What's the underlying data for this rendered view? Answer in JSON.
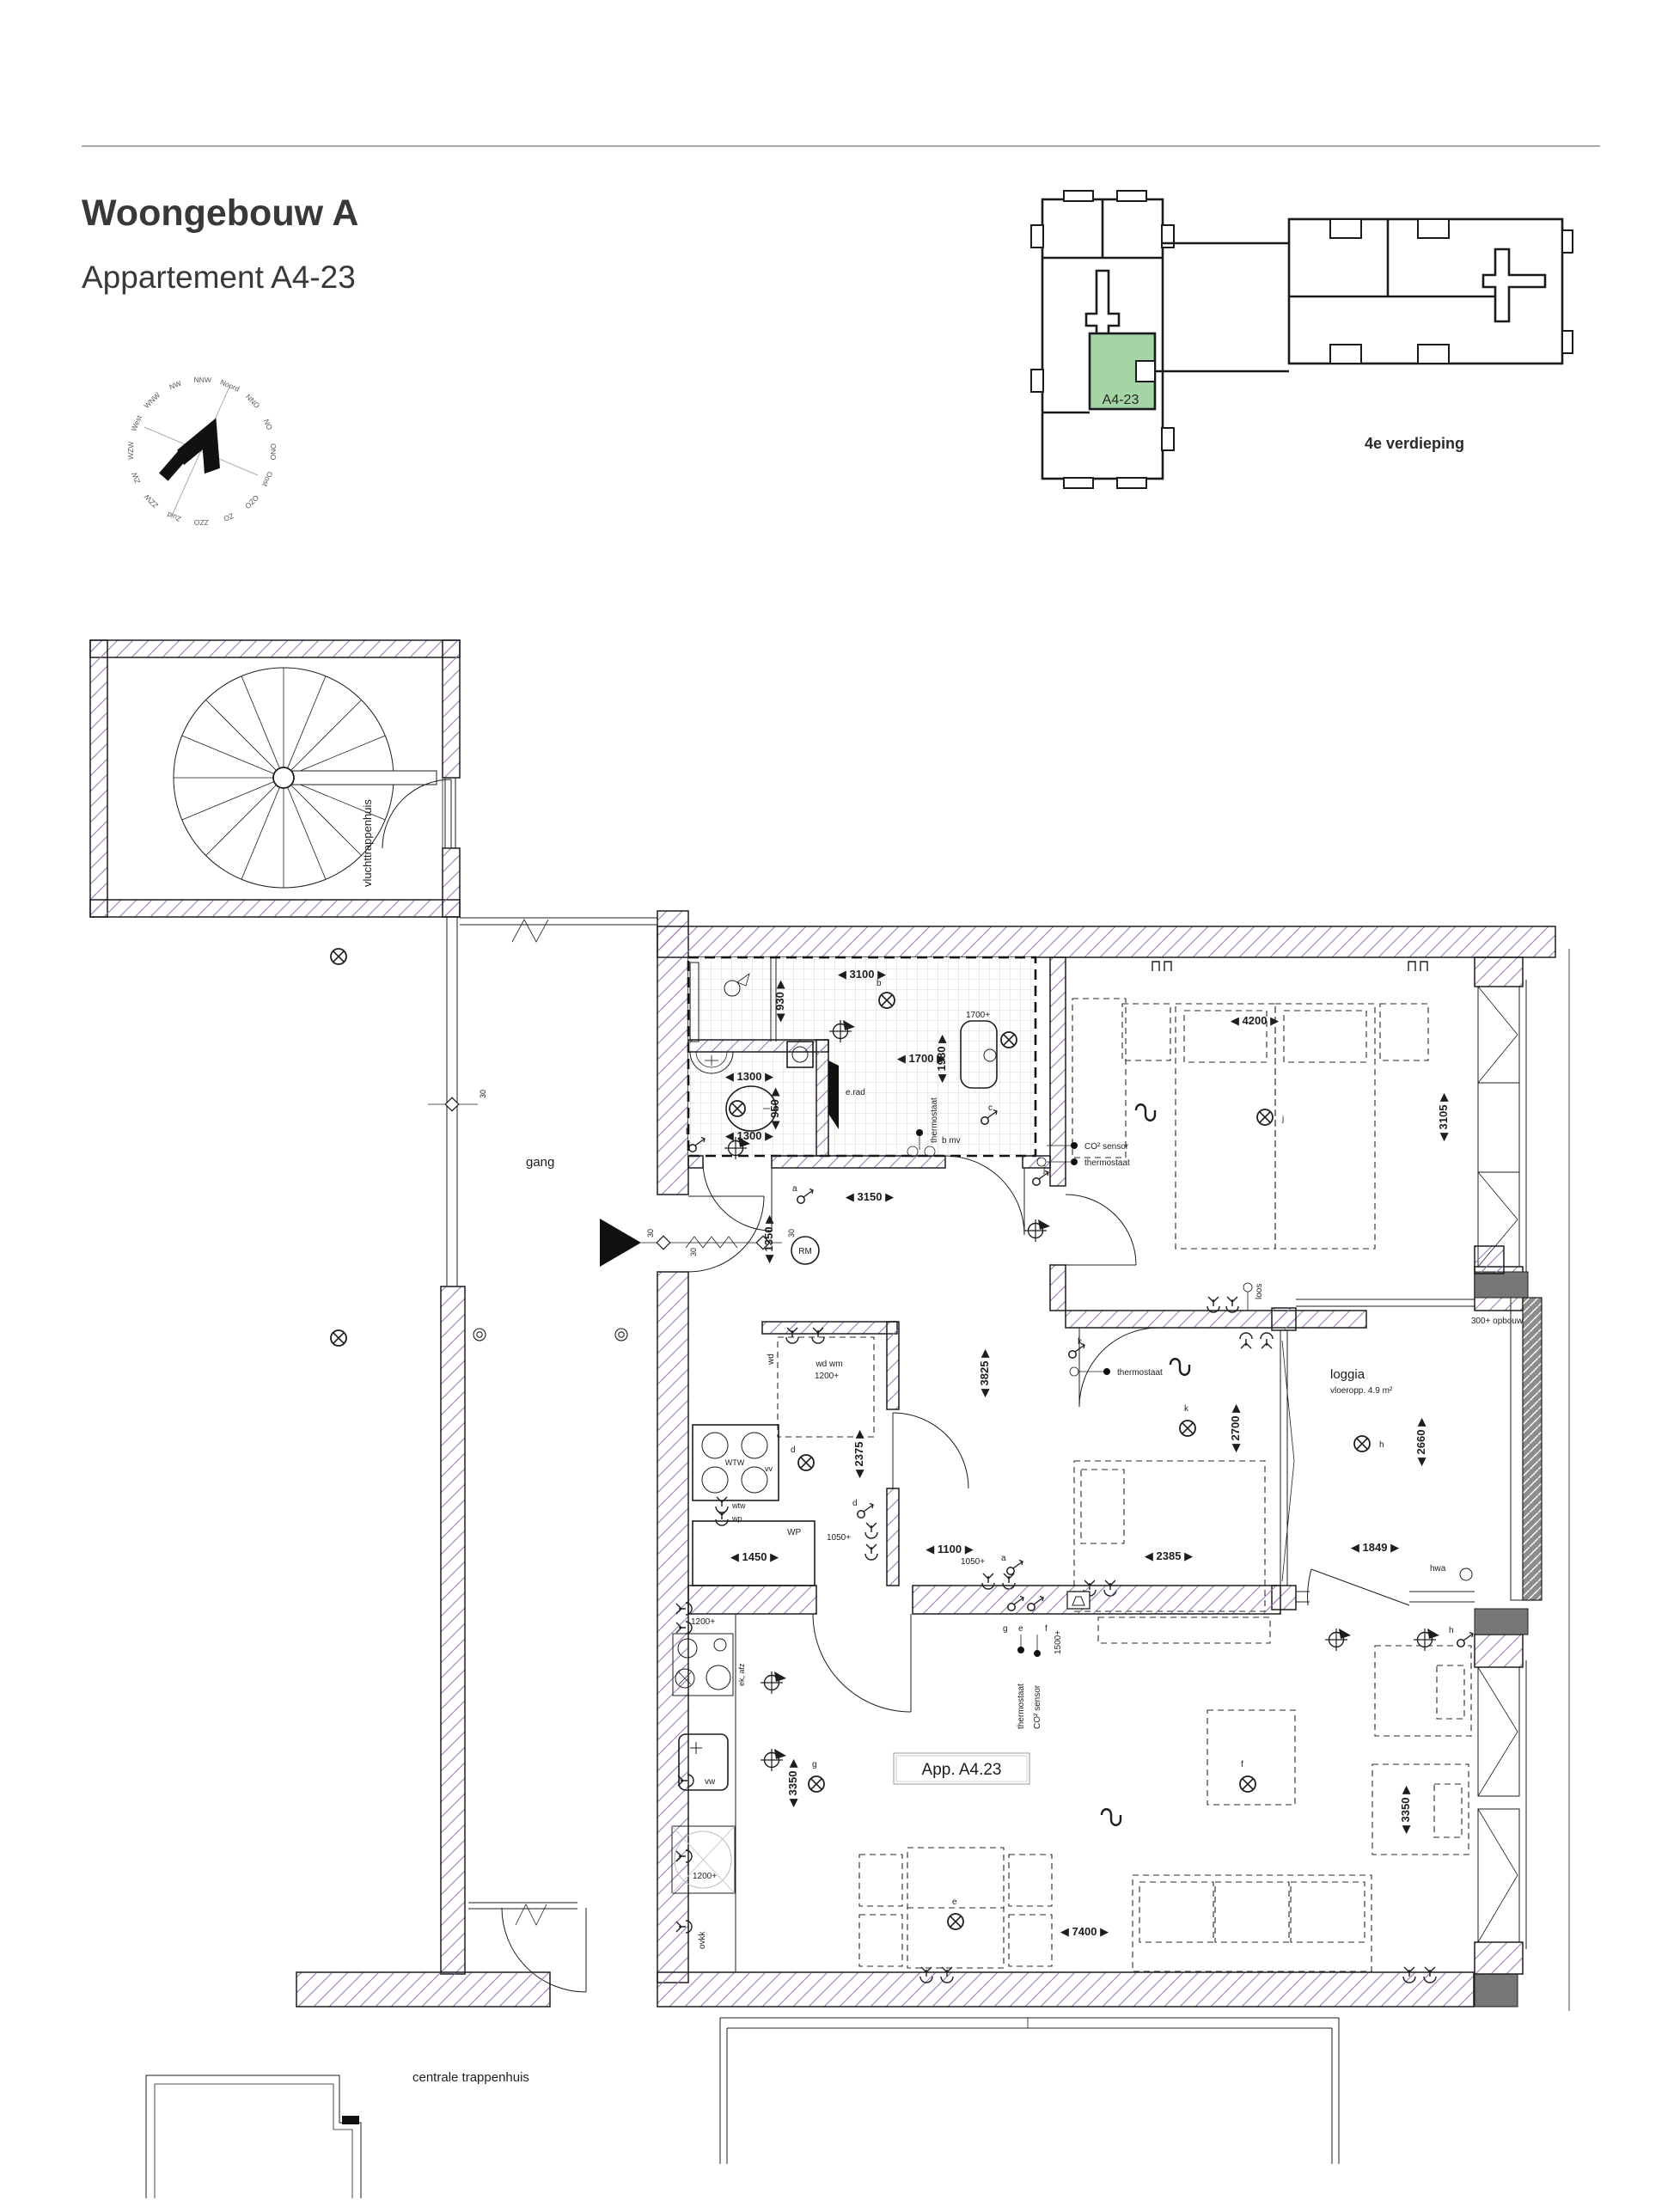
{
  "header": {
    "title": "Woongebouw A",
    "subtitle": "Appartement A4-23"
  },
  "keyplan": {
    "unit_label": "A4-23",
    "floor_label": "4e verdieping",
    "highlight_color": "#a6d5a5"
  },
  "compass": {
    "dirs": [
      "Noord",
      "NNO",
      "NO",
      "ONO",
      "Oost",
      "OZO",
      "ZO",
      "ZZO",
      "Zuid",
      "ZZW",
      "ZW",
      "WZW",
      "West",
      "WNW",
      "NW",
      "NNW"
    ]
  },
  "rooms": {
    "gang": "gang",
    "vluchttrappenhuis": "vluchttrappenhuis",
    "centrale_trappenhuis": "centrale trappenhuis",
    "loggia": "loggia",
    "loggia_area": "vloeropp. 4.9 m²",
    "app_label": "App. A4.23"
  },
  "legend": {
    "co2": "CO² sensor",
    "thermostaat": "thermostaat"
  },
  "dims": {
    "bath_total": "◀ 3100 ▶",
    "shower": "◀ 930 ▶",
    "bath_w": "◀ 1700 ▶",
    "bath_h": "◀ 1980 ▶",
    "wc_top": "◀ 1300 ▶",
    "wc_side": "◀ 950 ▶",
    "wc_bottom": "◀ 1300 ▶",
    "hall_w": "◀ 3150 ▶",
    "hall_entry": "◀ 1350 ▶",
    "hall_len": "◀ 3825 ▶",
    "tech": "◀ 2375 ▶",
    "wp": "◀ 1450 ▶",
    "hall_pass": "◀ 1100 ▶",
    "bed1_w": "◀ 4200 ▶",
    "bed1_d": "◀ 3105 ▶",
    "bed2_d": "◀ 2700 ▶",
    "bed2_w": "◀ 2385 ▶",
    "loggia_d": "◀ 2660 ▶",
    "loggia_w": "◀ 1849 ▶",
    "kitchen": "◀ 3350 ▶",
    "living_w": "◀ 7400 ▶",
    "living_d": "◀ 3350 ▶"
  },
  "marks": {
    "rm": "RM",
    "erad": "e.rad",
    "bmv": "b mv",
    "plus_1700": "1700+",
    "plus_1200": "1200+",
    "plus_1050": "1050+",
    "plus_1500": "1500+",
    "opbouw": "300+ opbouw",
    "wd": "wd",
    "wdwm": "wd wm",
    "wtw_unit": "WTW",
    "vv": "vv",
    "wtw": "wtw",
    "wp": "wp",
    "wp_unit": "WP",
    "ek_afz": "ek, afz",
    "vw": "vw",
    "ovkk": "ovkk",
    "loos": "loos",
    "hwa": "hwa",
    "fire": "30"
  },
  "switches": {
    "a": "a",
    "b": "b",
    "c": "c",
    "d": "d",
    "e": "e",
    "f": "f",
    "g": "g",
    "h": "h",
    "j": "j",
    "k": "k",
    "l": "l"
  }
}
